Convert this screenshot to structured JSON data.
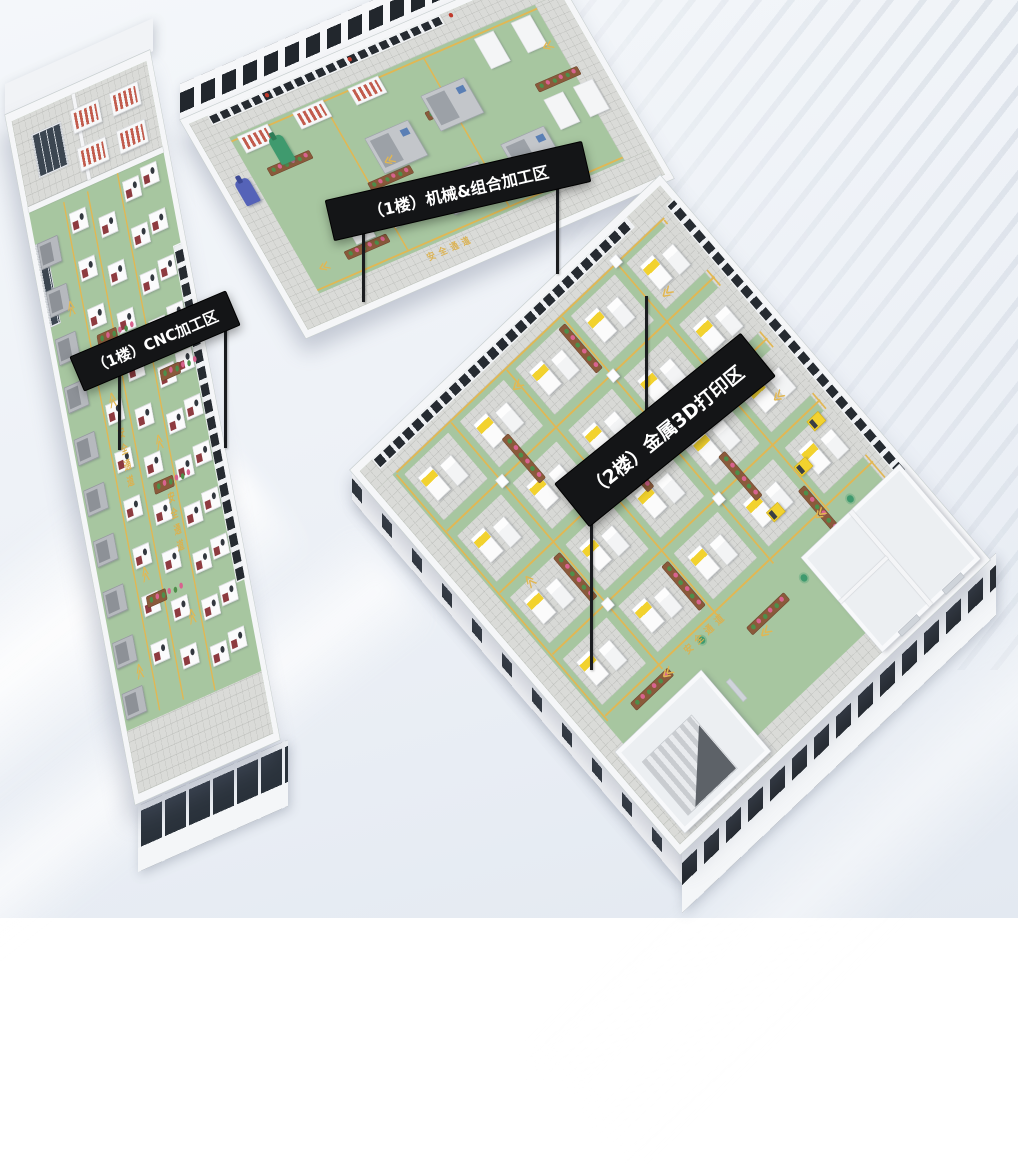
{
  "meta": {
    "scene_type": "isometric 3D factory floor-plan render",
    "language": "zh-CN"
  },
  "palette": {
    "background": "#ecf0f6",
    "floor_green": "#a7c6a0",
    "lane_yellow": "#e2b752",
    "tile_gray": "#dadbd8",
    "wall_white": "#f5f6f8",
    "banner_black": "#141517",
    "banner_text": "#ffffff",
    "machine_yellow": "#f2d22e",
    "cnc_red": "#8e3b40",
    "robot_blue": "#5563b8",
    "robot_green": "#3f9a6e",
    "planter_brown": "#8a5a3b",
    "flower_pink": "#d8638f"
  },
  "banners": [
    {
      "id": "cnc",
      "label": "（1楼）CNC加工区"
    },
    {
      "id": "mech",
      "label": "（1楼）机械&组合加工区"
    },
    {
      "id": "print",
      "label": "（2楼）金属3D打印区"
    }
  ],
  "floor_markings": {
    "safety_lane_text": "安全通道",
    "chevron_glyph": "≪"
  },
  "sprites": {
    "cnc": [
      {
        "type": "tile",
        "rects": [
          [
            0,
            0,
            316,
            118
          ],
          [
            0,
            840,
            316,
            86
          ]
        ]
      },
      {
        "type": "wallseg",
        "rects": [
          [
            0,
            118,
            316,
            8
          ],
          [
            140,
            0,
            8,
            118
          ]
        ]
      },
      {
        "type": "glass",
        "rects": [
          [
            0,
            170,
            20,
            110
          ],
          [
            36,
            28,
            66,
            56
          ]
        ]
      },
      {
        "type": "wall-glass-v",
        "rects": [
          [
            298,
            250,
            18,
            460
          ]
        ]
      },
      {
        "type": "shelf",
        "grid": [
          130,
          20,
          2,
          2,
          92,
          52
        ]
      },
      {
        "type": "machine-gray",
        "grid": [
          4,
          440,
          1,
          6,
          0,
          70
        ]
      },
      {
        "type": "machine-gray",
        "grid": [
          4,
          170,
          1,
          4,
          0,
          66
        ]
      },
      {
        "type": "machine-cnc",
        "grid": [
          86,
          150,
          1,
          10,
          0,
          66
        ]
      },
      {
        "type": "machine-cnc",
        "grid": [
          148,
          172,
          1,
          10,
          0,
          66
        ]
      },
      {
        "type": "machine-cnc",
        "grid": [
          214,
          140,
          1,
          11,
          0,
          64
        ]
      },
      {
        "type": "machine-cnc",
        "grid": [
          258,
          132,
          1,
          11,
          0,
          64
        ]
      },
      {
        "type": "vline",
        "lines": [
          [
            78,
            132,
            700
          ],
          [
            134,
            132,
            700
          ],
          [
            206,
            126,
            712
          ]
        ]
      },
      {
        "type": "planter",
        "w": 44,
        "at": [
          [
            96,
            320,
            0
          ],
          [
            158,
            540,
            0
          ],
          [
            218,
            400,
            0
          ],
          [
            96,
            680,
            0
          ]
        ]
      },
      {
        "type": "lane-text",
        "mode": "v",
        "at": [
          [
            96,
            450,
            0
          ],
          [
            178,
            560,
            0
          ]
        ]
      },
      {
        "type": "chevron",
        "at": [
          [
            92,
            400,
            90
          ],
          [
            92,
            640,
            90
          ],
          [
            176,
            480,
            90
          ],
          [
            176,
            720,
            90
          ],
          [
            40,
            260,
            90
          ],
          [
            40,
            760,
            90
          ]
        ]
      }
    ],
    "mech": [
      {
        "type": "tile",
        "rects": [
          [
            0,
            0,
            776,
            48
          ],
          [
            0,
            348,
            776,
            48
          ],
          [
            0,
            48,
            56,
            300
          ],
          [
            720,
            48,
            56,
            300
          ]
        ]
      },
      {
        "type": "hline",
        "lines": [
          [
            56,
            54,
            664
          ],
          [
            56,
            340,
            664
          ]
        ]
      },
      {
        "type": "vline",
        "lines": [
          [
            252,
            54,
            286
          ],
          [
            472,
            54,
            286
          ]
        ]
      },
      {
        "type": "wall-glass-h",
        "rects": [
          [
            40,
            0,
            500,
            14
          ]
        ]
      },
      {
        "type": "dot-red",
        "at": [
          [
            160,
            4,
            0
          ],
          [
            340,
            4,
            0
          ],
          [
            560,
            4,
            0
          ]
        ]
      },
      {
        "type": "shelf",
        "grid": [
          70,
          52,
          3,
          1,
          120,
          0
        ]
      },
      {
        "type": "planter",
        "at": [
          [
            90,
            120,
            0
          ],
          [
            250,
            210,
            0
          ],
          [
            420,
            140,
            0
          ],
          [
            560,
            300,
            0
          ],
          [
            640,
            170,
            0
          ],
          [
            140,
            300,
            0
          ]
        ]
      },
      {
        "type": "robot-blue",
        "at": [
          [
            18,
            120,
            0
          ]
        ]
      },
      {
        "type": "robot-green",
        "at": [
          [
            120,
            76,
            0
          ]
        ]
      },
      {
        "type": "machine-big",
        "at": [
          [
            290,
            140,
            0
          ],
          [
            430,
            112,
            0
          ],
          [
            370,
            250,
            0
          ],
          [
            520,
            240,
            0
          ]
        ]
      },
      {
        "type": "workbench",
        "grid": [
          580,
          60,
          2,
          1,
          80,
          0
        ]
      },
      {
        "type": "workbench",
        "grid": [
          640,
          200,
          2,
          1,
          64,
          0
        ]
      },
      {
        "type": "workbench",
        "grid": [
          170,
          240,
          2,
          1,
          84,
          0
        ]
      },
      {
        "type": "chevron",
        "at": [
          [
            80,
            300,
            0
          ],
          [
            690,
            110,
            0
          ],
          [
            300,
            180,
            0
          ]
        ]
      },
      {
        "type": "lane-text",
        "mode": "h",
        "at": [
          [
            280,
            352,
            0
          ]
        ]
      }
    ],
    "print": [
      {
        "type": "tile",
        "rects": [
          [
            0,
            0,
            736,
            40
          ],
          [
            0,
            736,
            736,
            40
          ],
          [
            0,
            40,
            40,
            696
          ],
          [
            696,
            40,
            40,
            696
          ]
        ]
      },
      {
        "type": "wall-glass-h",
        "rects": [
          [
            30,
            0,
            620,
            16
          ]
        ]
      },
      {
        "type": "wall-glass-v",
        "rects": [
          [
            720,
            30,
            16,
            560
          ]
        ]
      },
      {
        "type": "vline",
        "lines": [
          [
            44,
            44,
            512
          ],
          [
            178,
            44,
            512
          ],
          [
            314,
            44,
            512
          ],
          [
            450,
            44,
            512
          ],
          [
            586,
            44,
            512
          ],
          [
            700,
            44,
            560
          ]
        ]
      },
      {
        "type": "hline",
        "lines": [
          [
            48,
            40,
            656
          ],
          [
            48,
            162,
            656
          ],
          [
            48,
            290,
            656
          ],
          [
            48,
            418,
            656
          ],
          [
            48,
            546,
            656
          ]
        ]
      },
      {
        "type": "pad",
        "grid": [
          56,
          52,
          5,
          4,
          136,
          128
        ]
      },
      {
        "type": "column",
        "at": [
          [
            172,
            158,
            0
          ],
          [
            444,
            158,
            0
          ],
          [
            172,
            414,
            0
          ],
          [
            444,
            414,
            0
          ],
          [
            308,
            286,
            0
          ],
          [
            580,
            286,
            0
          ],
          [
            580,
            30,
            0
          ]
        ]
      },
      {
        "type": "planter",
        "at": [
          [
            244,
            118,
            90
          ],
          [
            380,
            246,
            90
          ],
          [
            516,
            374,
            90
          ],
          [
            176,
            310,
            90
          ],
          [
            312,
            438,
            90
          ],
          [
            448,
            54,
            90
          ],
          [
            584,
            500,
            90
          ],
          [
            96,
            560,
            0
          ],
          [
            340,
            600,
            0
          ]
        ]
      },
      {
        "type": "agv",
        "at": [
          [
            500,
            490,
            0
          ],
          [
            590,
            468,
            0
          ],
          [
            660,
            430,
            0
          ]
        ]
      },
      {
        "type": "room",
        "rects": [
          [
            20,
            600,
            210,
            168
          ],
          [
            496,
            580,
            240,
            196
          ]
        ]
      },
      {
        "type": "wallseg",
        "rects": [
          [
            612,
            580,
            8,
            196
          ],
          [
            496,
            670,
            116,
            6
          ]
        ]
      },
      {
        "type": "stair",
        "rects": [
          [
            44,
            640,
            120,
            110
          ]
        ]
      },
      {
        "type": "stair-tri",
        "rects": [
          [
            64,
            660,
            100,
            90
          ]
        ]
      },
      {
        "type": "door",
        "rects": [
          [
            540,
            770,
            44,
            8
          ],
          [
            648,
            770,
            44,
            8
          ],
          [
            250,
            640,
            8,
            40
          ]
        ]
      },
      {
        "type": "plant",
        "at": [
          [
            470,
            600,
            0
          ],
          [
            624,
            560,
            0
          ],
          [
            260,
            560,
            0
          ]
        ]
      },
      {
        "type": "lane-text",
        "mode": "h",
        "at": [
          [
            230,
            548,
            0
          ],
          [
            420,
            296,
            0
          ]
        ]
      },
      {
        "type": "chevron",
        "at": [
          [
            170,
            556,
            0
          ],
          [
            560,
            540,
            0
          ],
          [
            350,
            616,
            0
          ],
          [
            640,
            360,
            0
          ],
          [
            90,
            300,
            90
          ],
          [
            610,
            120,
            0
          ],
          [
            300,
            64,
            0
          ]
        ]
      }
    ]
  }
}
